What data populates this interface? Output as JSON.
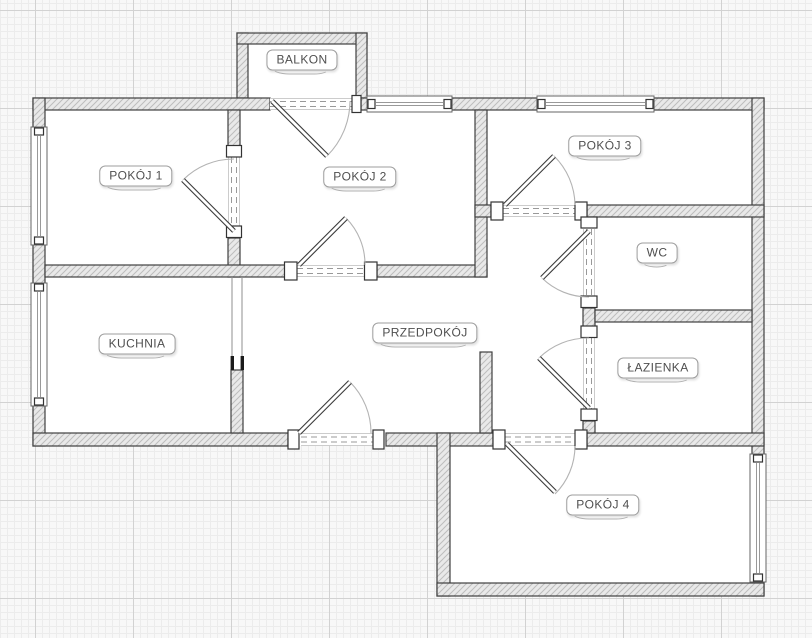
{
  "floor_plan": {
    "type": "apartment-floor-plan",
    "language": "pl",
    "rooms": [
      {
        "id": "balkon",
        "label": "BALKON",
        "label_center_px": {
          "x": 302,
          "y": 60
        }
      },
      {
        "id": "pokoj-1",
        "label": "POKÓJ 1",
        "label_center_px": {
          "x": 136,
          "y": 176
        }
      },
      {
        "id": "pokoj-2",
        "label": "POKÓJ 2",
        "label_center_px": {
          "x": 360,
          "y": 177
        }
      },
      {
        "id": "pokoj-3",
        "label": "POKÓJ 3",
        "label_center_px": {
          "x": 605,
          "y": 146
        }
      },
      {
        "id": "wc",
        "label": "WC",
        "label_center_px": {
          "x": 657,
          "y": 253
        }
      },
      {
        "id": "kuchnia",
        "label": "KUCHNIA",
        "label_center_px": {
          "x": 137,
          "y": 344
        }
      },
      {
        "id": "przedpokoj",
        "label": "PRZEDPOKÓJ",
        "label_center_px": {
          "x": 425,
          "y": 333
        }
      },
      {
        "id": "lazienka",
        "label": "ŁAZIENKA",
        "label_center_px": {
          "x": 658,
          "y": 368
        }
      },
      {
        "id": "pokoj-4",
        "label": "POKÓJ 4",
        "label_center_px": {
          "x": 603,
          "y": 505
        }
      }
    ],
    "doors": [
      {
        "id": "door-balkon",
        "between": [
          "BALKON",
          "POKÓJ 2"
        ],
        "swings_into": "POKÓJ 2"
      },
      {
        "id": "door-pokoj-1",
        "between": [
          "POKÓJ 2",
          "POKÓJ 1"
        ],
        "swings_into": "POKÓJ 1"
      },
      {
        "id": "door-pokoj-2",
        "between": [
          "PRZEDPOKÓJ",
          "POKÓJ 2"
        ],
        "swings_into": "POKÓJ 2"
      },
      {
        "id": "door-pokoj-3",
        "between": [
          "PRZEDPOKÓJ",
          "POKÓJ 3"
        ],
        "swings_into": "POKÓJ 3"
      },
      {
        "id": "door-wc",
        "between": [
          "PRZEDPOKÓJ",
          "WC"
        ],
        "swings_into": "PRZEDPOKÓJ"
      },
      {
        "id": "door-lazienka",
        "between": [
          "PRZEDPOKÓJ",
          "ŁAZIENKA"
        ],
        "swings_into": "PRZEDPOKÓJ"
      },
      {
        "id": "door-entrance",
        "between": [
          "PRZEDPOKÓJ",
          "outside"
        ],
        "swings_into": "PRZEDPOKÓJ"
      },
      {
        "id": "door-pokoj-4",
        "between": [
          "PRZEDPOKÓJ",
          "POKÓJ 4"
        ],
        "swings_into": "POKÓJ 4"
      }
    ],
    "passages": [
      {
        "id": "passage-kuchnia",
        "between": [
          "PRZEDPOKÓJ",
          "KUCHNIA"
        ],
        "type": "open-passage"
      }
    ],
    "windows": [
      {
        "id": "window-pokoj-1",
        "wall": "left"
      },
      {
        "id": "window-kuchnia",
        "wall": "left"
      },
      {
        "id": "window-pokoj-2",
        "wall": "top"
      },
      {
        "id": "window-pokoj-3",
        "wall": "top"
      },
      {
        "id": "window-pokoj-4",
        "wall": "right"
      }
    ],
    "colors": {
      "wall_fill": "#e9e9e9",
      "wall_hatch": "#bdbdbd",
      "wall_border": "#3f3f3f",
      "symbol_gray": "#999999",
      "label_text": "#4f4f4f",
      "label_border": "#9e9e9e",
      "floor": "#ffffff",
      "canvas": "#f8f8f8",
      "grid_minor": "#ececec",
      "grid_major": "#d2d2d2"
    }
  }
}
